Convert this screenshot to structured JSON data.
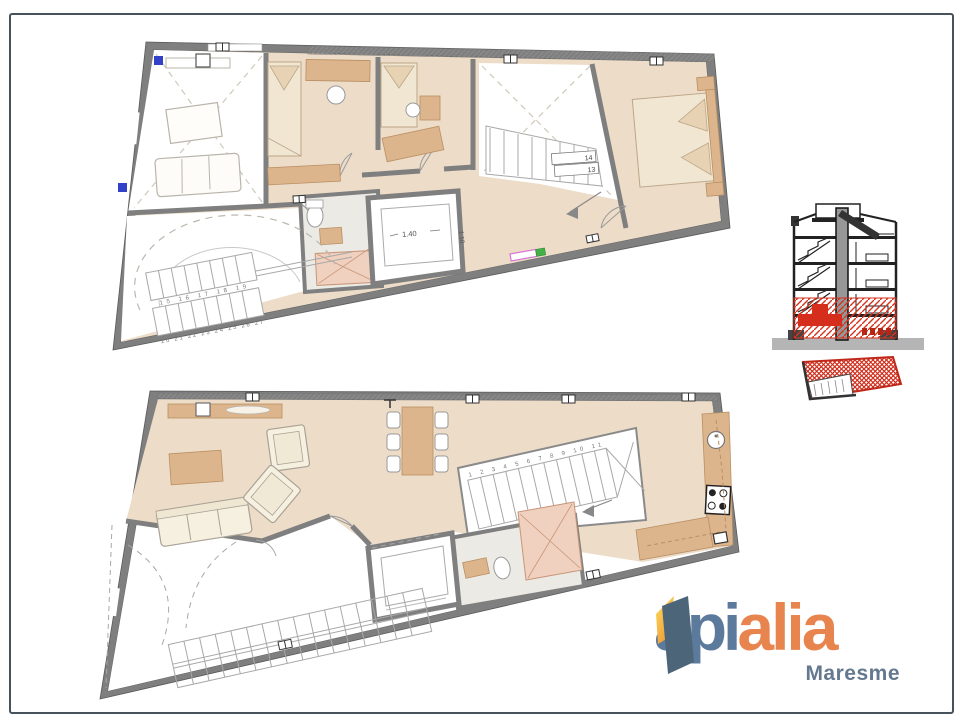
{
  "page": {
    "type": "real-estate floor plan sheet",
    "background": "#ffffff",
    "frame_color": "#47525a"
  },
  "palette": {
    "frameColor": "#47525a",
    "wall": "#7f7f7f",
    "wallEdge": "#5a5a5a",
    "floorTan": "#ecdcc8",
    "furnTan": "#ddb58d",
    "bedFill": "#f0e6d2",
    "cream": "#f6f0e0",
    "bathFloor": "#ebeae5",
    "shower": "#f0d0bf",
    "lineGray": "#9a968e",
    "dashTan": "#ccc4b6",
    "red": "#d62e1d",
    "redDark": "#b52615",
    "ground": "#b5b5b5",
    "blueMark": "#3340c8",
    "greenMark": "#44b04a",
    "magentaMark": "#d873d8",
    "logoBlue": "#5c7a9c",
    "logoOrange": "#e8854f",
    "logoDoor": "#4d6579",
    "maresmeBlue": "#64798f"
  },
  "upper_plan": {
    "name": "upper floor plan",
    "elevator_width_label": "1.40",
    "elevator_depth_label": "1.10",
    "ramp_stair_numbers_row1": "15 16 17 18 19",
    "ramp_stair_numbers_row2": "20 21 22 23 24 25 26 27",
    "stairwell_tread_labels": [
      "14",
      "13"
    ]
  },
  "lower_plan": {
    "name": "lower floor plan",
    "stair_numbers": "1 2 3 4 5 6 7 8 9 10 11"
  },
  "section_diagram": {
    "name": "building cross-section",
    "highlight_color": "#d62e1d"
  },
  "site_plan": {
    "name": "location plan",
    "highlight_color": "#d62e1d"
  },
  "logo": {
    "word_part_blue": "api",
    "word_part_orange": "alia",
    "region": "Maresme"
  }
}
